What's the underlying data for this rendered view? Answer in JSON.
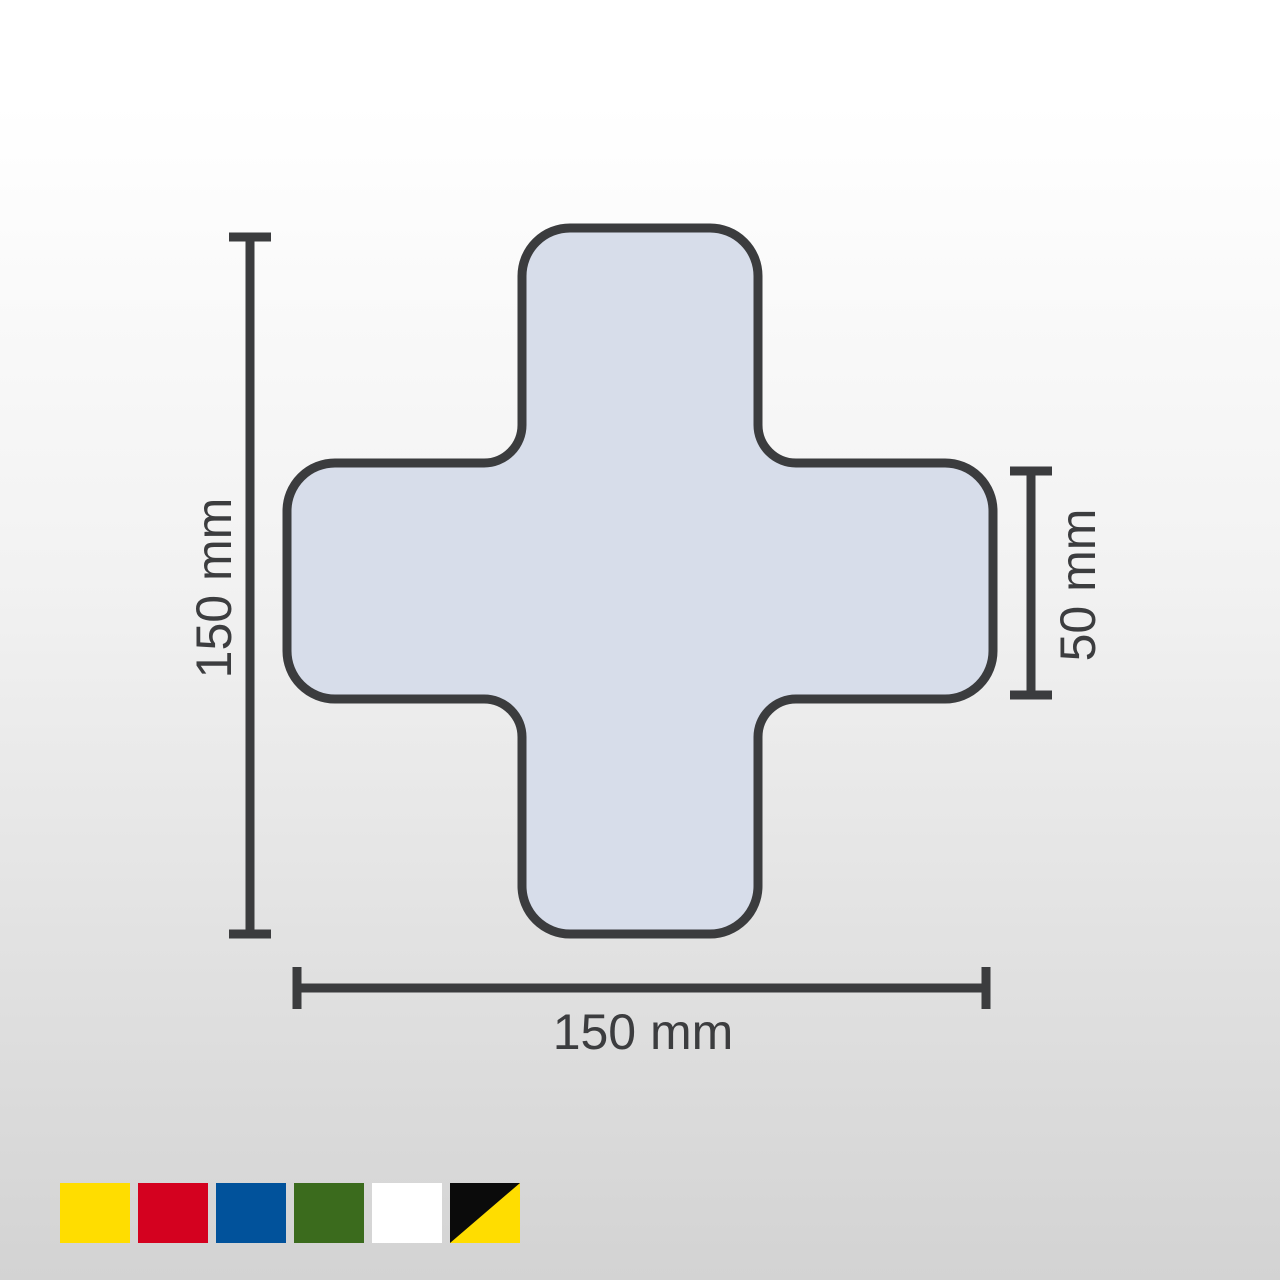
{
  "page": {
    "background_top": "#FFFFFF",
    "background_bottom": "#D3D3D3"
  },
  "diagram": {
    "shape_name": "cross floor marking",
    "shape_fill": "#D7DDEA",
    "shape_stroke": "#3B3C3E",
    "line_color": "#3B3C3E",
    "text_color": "#3C3D3F",
    "dimensions": {
      "height": "150 mm",
      "width": "150 mm",
      "arm_width": "50 mm"
    }
  },
  "color_options": [
    {
      "name": "yellow",
      "color": "#FFDD00"
    },
    {
      "name": "red",
      "color": "#D4011F"
    },
    {
      "name": "blue",
      "color": "#01529B"
    },
    {
      "name": "green",
      "color": "#3B6B1D"
    },
    {
      "name": "white",
      "color": "#FFFFFF"
    },
    {
      "name": "black-yellow",
      "color": "#0B0B0B",
      "color2": "#FFDD00"
    }
  ]
}
